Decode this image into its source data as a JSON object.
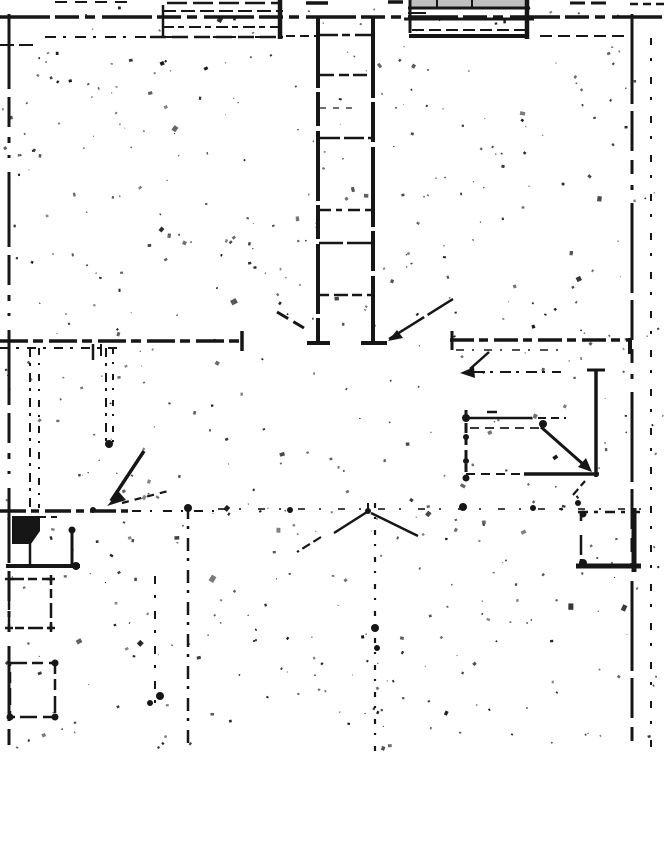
{
  "document": {
    "kind": "scanned architectural floor plan",
    "visible_text": [],
    "canvas": {
      "width": 666,
      "height": 855,
      "drawing_bottom": 752
    }
  },
  "colors": {
    "paper": "#ffffff",
    "ink": "#161616",
    "window_shade": "#969696"
  },
  "drawing": {
    "groups": [
      {
        "name": "outer-walls",
        "lines": [
          [
            0,
            17,
            666,
            17,
            3.5,
            "50 5 24 6 10 7"
          ],
          [
            9,
            14,
            9,
            745,
            3,
            "75 8 30 10 6 12 3 14"
          ],
          [
            632,
            14,
            632,
            745,
            3,
            "90 7 40 9 14 11 5 13"
          ],
          [
            651,
            38,
            651,
            748,
            2,
            "7 13 3 16"
          ],
          [
            45,
            37,
            283,
            37,
            2,
            "11 7 3 9"
          ],
          [
            286,
            36,
            316,
            36,
            2,
            "9 5"
          ],
          [
            540,
            36,
            630,
            36,
            2,
            "12 6"
          ],
          [
            0,
            45,
            33,
            45,
            2,
            "14 5"
          ]
        ]
      },
      {
        "name": "edge-stubs",
        "lines": [
          [
            55,
            2,
            130,
            2,
            2,
            "12 8"
          ],
          [
            306,
            3,
            328,
            3,
            3.5
          ],
          [
            388,
            2,
            403,
            2,
            3.5
          ],
          [
            570,
            3,
            612,
            3,
            3,
            "15 6"
          ],
          [
            630,
            4,
            666,
            4,
            2.5,
            "8 5"
          ]
        ]
      },
      {
        "name": "top-left-window",
        "lines": [
          [
            167,
            3,
            279,
            3,
            2.5,
            "20 6"
          ],
          [
            162,
            11,
            283,
            11,
            2,
            "14 5"
          ],
          [
            162,
            27,
            278,
            27,
            2,
            "12 4 6 5"
          ],
          [
            163,
            5,
            163,
            38,
            2.5
          ],
          [
            280,
            0,
            280,
            39,
            4.5
          ],
          [
            150,
            37,
            283,
            37,
            2.5,
            "16 6"
          ]
        ]
      },
      {
        "name": "top-right-window",
        "polys": [
          {
            "fill": "#969696",
            "op": 0.6,
            "pts": [
              [
                409,
                0
              ],
              [
                527,
                0
              ],
              [
                527,
                8
              ],
              [
                409,
                8
              ]
            ]
          }
        ],
        "lines": [
          [
            408,
            8,
            530,
            8,
            3
          ],
          [
            404,
            19,
            534,
            19,
            3
          ],
          [
            412,
            30,
            526,
            30,
            2,
            "12 5"
          ],
          [
            409,
            36,
            529,
            36,
            4
          ],
          [
            410,
            0,
            410,
            33,
            3
          ],
          [
            527,
            0,
            527,
            39,
            4.5
          ],
          [
            437,
            0,
            437,
            8,
            2
          ],
          [
            472,
            0,
            472,
            8,
            2
          ],
          [
            408,
            13,
            426,
            13,
            2
          ]
        ]
      },
      {
        "name": "staircase",
        "lines": [
          [
            318,
            18,
            318,
            343,
            4,
            "70 4 34 5"
          ],
          [
            373,
            18,
            373,
            343,
            4,
            "80 4 40 5"
          ],
          [
            307,
            343,
            330,
            343,
            4
          ],
          [
            361,
            343,
            387,
            343,
            4
          ],
          [
            320,
            35,
            371,
            35,
            2.5,
            "18 4 8 5"
          ],
          [
            320,
            75,
            371,
            75,
            2.5,
            "14 5 10 4"
          ],
          [
            320,
            108,
            352,
            108,
            1.8,
            "6 7",
            0.7
          ],
          [
            320,
            138,
            371,
            138,
            2.4,
            "20 4"
          ],
          [
            319,
            210,
            371,
            210,
            2.4,
            "12 5 6 6"
          ],
          [
            319,
            243,
            371,
            243,
            2.6,
            "24 4"
          ],
          [
            319,
            295,
            371,
            295,
            2.4,
            "10 5 14 4"
          ]
        ]
      },
      {
        "name": "interior-walls",
        "lines": [
          [
            0,
            341,
            243,
            341,
            3.5,
            "28 5 10 6"
          ],
          [
            0,
            348,
            122,
            348,
            2,
            "9 7 3 8"
          ],
          [
            242,
            331,
            242,
            351,
            3.5
          ],
          [
            450,
            340,
            632,
            340,
            3.5,
            "24 5 9 6"
          ],
          [
            456,
            350,
            560,
            350,
            1.8,
            "8 8 2 10",
            0.85
          ],
          [
            452,
            331,
            452,
            350,
            3
          ],
          [
            630,
            338,
            630,
            354,
            4
          ],
          [
            30,
            348,
            30,
            508,
            2,
            "9 6 3 7"
          ],
          [
            39,
            348,
            39,
            508,
            2,
            "7 8 2 9"
          ],
          [
            106,
            348,
            106,
            444,
            2,
            "9 6 3 7"
          ],
          [
            113,
            348,
            113,
            442,
            2,
            "6 8 2 10"
          ],
          [
            93,
            344,
            93,
            360,
            2.5
          ],
          [
            101,
            344,
            101,
            356,
            2
          ],
          [
            0,
            511,
            128,
            511,
            3.5,
            "26 5 8 6"
          ],
          [
            132,
            511,
            214,
            511,
            2,
            "9 9 2 11"
          ],
          [
            218,
            509,
            645,
            509,
            2,
            "7 14 2 17",
            0.8
          ],
          [
            155,
            576,
            155,
            708,
            2,
            "8 11 3 13"
          ],
          [
            188,
            506,
            188,
            750,
            2.5,
            "13 7 3 9"
          ],
          [
            375,
            503,
            375,
            752,
            2.2,
            "5 9 2 11"
          ]
        ],
        "dots": [
          [
            109,
            444,
            4
          ],
          [
            93,
            510,
            3
          ],
          [
            188,
            508,
            4
          ],
          [
            375,
            628,
            4
          ],
          [
            377,
            648,
            3
          ],
          [
            160,
            696,
            4
          ],
          [
            150,
            703,
            3
          ]
        ]
      },
      {
        "name": "left-fixtures",
        "polys": [
          {
            "fill": "#161616",
            "pts": [
              [
                12,
                516
              ],
              [
                40,
                516
              ],
              [
                40,
                531
              ],
              [
                31,
                544
              ],
              [
                12,
                544
              ]
            ]
          }
        ],
        "lines": [
          [
            6,
            566,
            80,
            566,
            4
          ],
          [
            72,
            531,
            72,
            568,
            3
          ],
          [
            30,
            544,
            30,
            567,
            2.5
          ],
          [
            40,
            517,
            58,
            517,
            2,
            "6 5"
          ]
        ],
        "rects": [
          [
            9,
            579,
            42,
            49,
            2.5,
            "15 4 9 5"
          ],
          [
            10,
            663,
            45,
            54,
            2.5,
            "17 5 11 6"
          ]
        ],
        "crosses": [
          [
            9,
            579,
            8
          ],
          [
            51,
            579,
            8
          ],
          [
            51,
            628,
            8
          ],
          [
            9,
            628,
            8
          ]
        ],
        "dots": [
          [
            72,
            530,
            3.5
          ],
          [
            76,
            566,
            4
          ],
          [
            55,
            663,
            3.5
          ],
          [
            55,
            717,
            3.5
          ],
          [
            10,
            717,
            3.5
          ]
        ]
      },
      {
        "name": "right-fixtures",
        "lines": [
          [
            466,
            410,
            466,
            480,
            3,
            "8 5 10 4"
          ],
          [
            466,
            418,
            532,
            418,
            2.5
          ],
          [
            538,
            418,
            566,
            418,
            2,
            "8 5"
          ],
          [
            470,
            428,
            545,
            428,
            2,
            "9 6",
            0.85
          ],
          [
            487,
            412,
            497,
            412,
            2.5
          ],
          [
            466,
            474,
            524,
            474,
            2,
            "9 6"
          ],
          [
            524,
            474,
            599,
            474,
            3.5
          ],
          [
            596,
            370,
            596,
            477,
            3.5
          ],
          [
            587,
            370,
            605,
            370,
            3
          ],
          [
            578,
            512,
            640,
            512,
            2.5,
            "10 6 4 7"
          ],
          [
            581,
            512,
            581,
            568,
            2.5,
            "9 14 20 4"
          ],
          [
            576,
            566,
            641,
            566,
            5
          ],
          [
            634,
            508,
            634,
            572,
            5
          ]
        ],
        "dots": [
          [
            466,
            418,
            4
          ],
          [
            466,
            437,
            3
          ],
          [
            466,
            461,
            3
          ],
          [
            466,
            478,
            3.5
          ],
          [
            543,
            424,
            4
          ],
          [
            583,
            514,
            3.5
          ],
          [
            583,
            563,
            4
          ],
          [
            463,
            507,
            4
          ],
          [
            533,
            508,
            3
          ],
          [
            578,
            503,
            3
          ]
        ]
      },
      {
        "name": "annotations",
        "lines": [
          [
            489,
            352,
            470,
            369,
            2.5
          ],
          [
            474,
            372,
            561,
            372,
            2,
            "11 5 3 7"
          ],
          [
            541,
            427,
            584,
            465,
            3
          ],
          [
            453,
            299,
            389,
            339,
            2.5,
            "30 4"
          ],
          [
            277,
            312,
            304,
            328,
            3,
            "13 6"
          ],
          [
            334,
            533,
            367,
            512,
            2.5
          ],
          [
            371,
            513,
            418,
            536,
            2.5
          ],
          [
            368,
            503,
            368,
            512,
            2
          ],
          [
            144,
            451,
            111,
            501,
            3.5
          ],
          [
            122,
            503,
            172,
            490,
            2.2,
            "7 6"
          ],
          [
            321,
            537,
            297,
            552,
            2.2,
            "9 4"
          ],
          [
            573,
            495,
            585,
            481,
            2.2,
            "8 4"
          ]
        ],
        "tris": [
          [
            [
              460,
              373
            ],
            [
              474,
              367
            ],
            [
              475,
              378
            ]
          ],
          [
            [
              592,
              472
            ],
            [
              578,
              467
            ],
            [
              586,
              458
            ]
          ],
          [
            [
              388,
              341
            ],
            [
              397,
              330
            ],
            [
              403,
              338
            ]
          ],
          [
            [
              107,
              506
            ],
            [
              119,
              492
            ],
            [
              126,
              500
            ]
          ]
        ],
        "dots": [
          [
            368,
            511,
            3
          ],
          [
            290,
            510,
            3
          ]
        ]
      }
    ],
    "noise": {
      "seed": 1234,
      "count": 540,
      "area": [
        3,
        6,
        660,
        742
      ]
    }
  }
}
